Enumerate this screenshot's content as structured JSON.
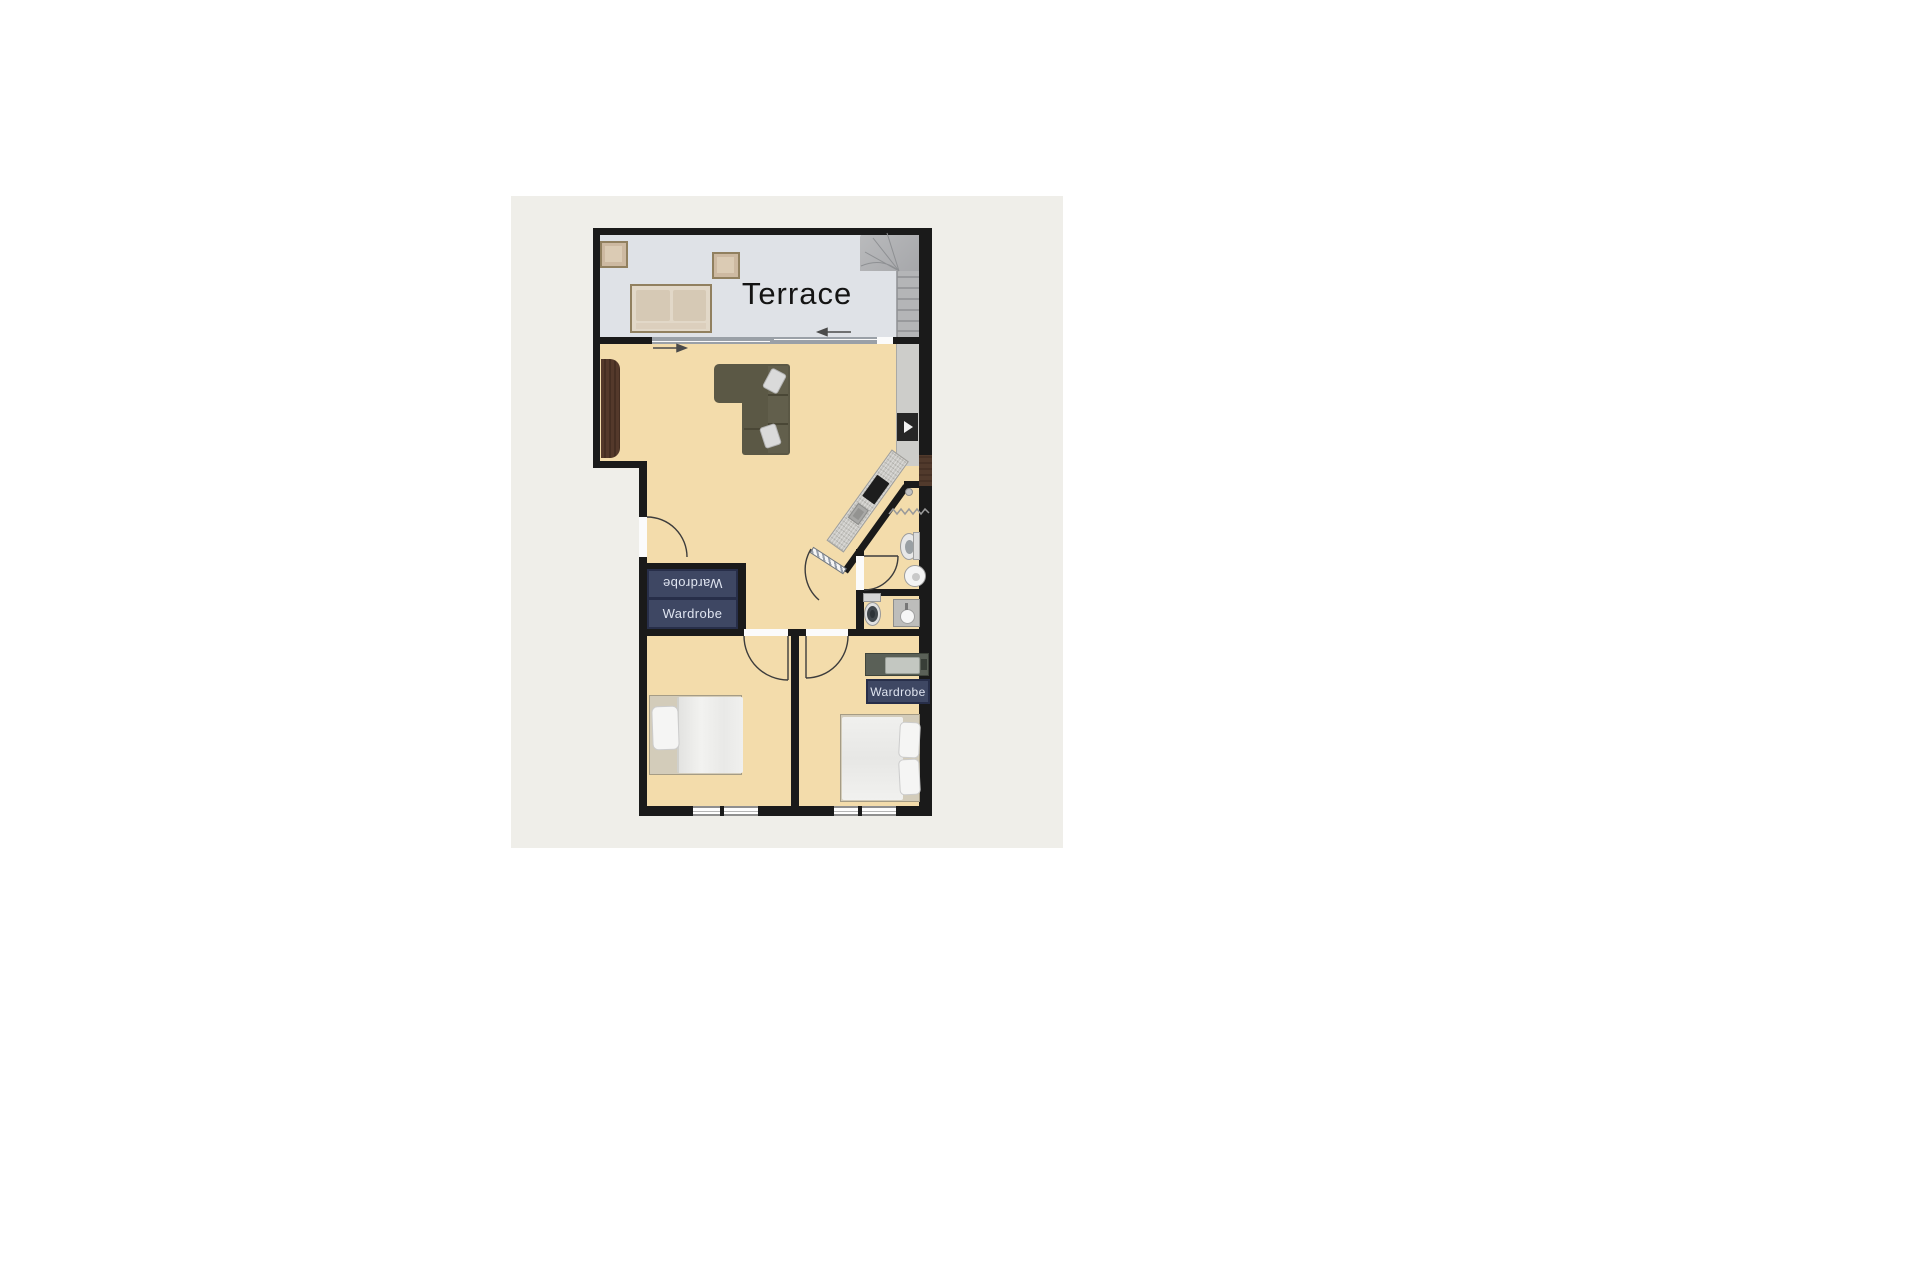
{
  "plan": {
    "terrace_label": "Terrace",
    "wardrobe_hall_top_label": "Wardrobe",
    "wardrobe_hall_bottom_label": "Wardrobe",
    "wardrobe_bedroom_label": "Wardrobe"
  },
  "colors": {
    "page_background": "#ffffff",
    "sheet_background": "#efeee9",
    "wall": "#1a1a1a",
    "floor_tan": "#f3dcab",
    "terrace_floor": "#dfe2e7",
    "stairs_gray": "#b4b5b7",
    "wardrobe_fill": "#3e4763",
    "wardrobe_border": "#272e49",
    "wardrobe_text": "#dfe4f0",
    "sofa_olive": "#5b5845",
    "sideboard_wood": "#54392b",
    "bench_tan": "#e2d8c8",
    "door_arc": "#3c3c3c",
    "arrow": "#4a4a4a"
  },
  "furniture_icons": [
    "staircase-icon",
    "outdoor-table-icon",
    "outdoor-table-icon",
    "outdoor-sofa-icon",
    "sliding-door-icon",
    "sideboard-icon",
    "corner-sofa-icon",
    "kitchen-counter-icon",
    "cooktop-icon",
    "kitchen-sink-icon",
    "kitchen-appliance-icon",
    "open-door-icon",
    "toilet-icon",
    "pedestal-sink-icon",
    "towel-radiator-icon",
    "toilet-icon",
    "vanity-sink-icon",
    "wardrobe-icon",
    "wardrobe-icon",
    "wardrobe-icon",
    "double-bed-icon",
    "double-bed-icon",
    "dresser-icon",
    "window-icon",
    "window-icon",
    "door-swing-icon"
  ]
}
